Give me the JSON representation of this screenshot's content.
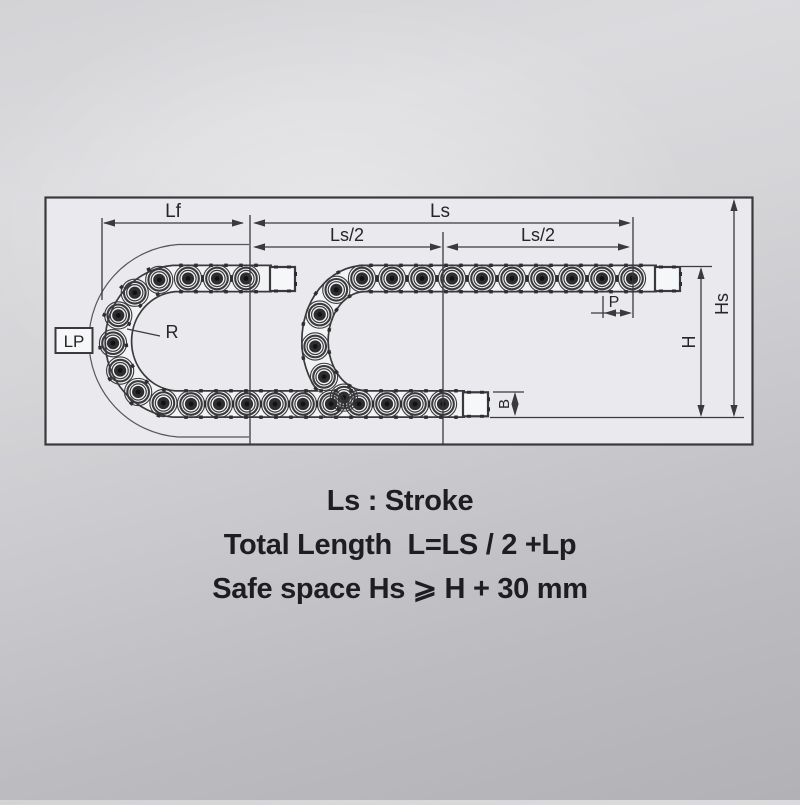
{
  "diagram": {
    "labels": {
      "lf": "Lf",
      "ls": "Ls",
      "ls2_left": "Ls/2",
      "ls2_right": "Ls/2",
      "p": "P",
      "r": "R",
      "lp": "LP",
      "h": "H",
      "hs": "Hs",
      "b": "B"
    }
  },
  "notes": {
    "line1": "Ls : Stroke",
    "line2": "Total Length  L=LS / 2 +Lp",
    "line3": "Safe space Hs ⩾ H + 30 mm"
  },
  "colors": {
    "line": "#3a3a3c",
    "chain": "#2e2e31",
    "chain_core": "#121214",
    "frame_fill": "#eaeaee",
    "band_fill": "#f2f3f5",
    "bracket_fill": "#f6f7f9",
    "text": "#1e1e20"
  }
}
